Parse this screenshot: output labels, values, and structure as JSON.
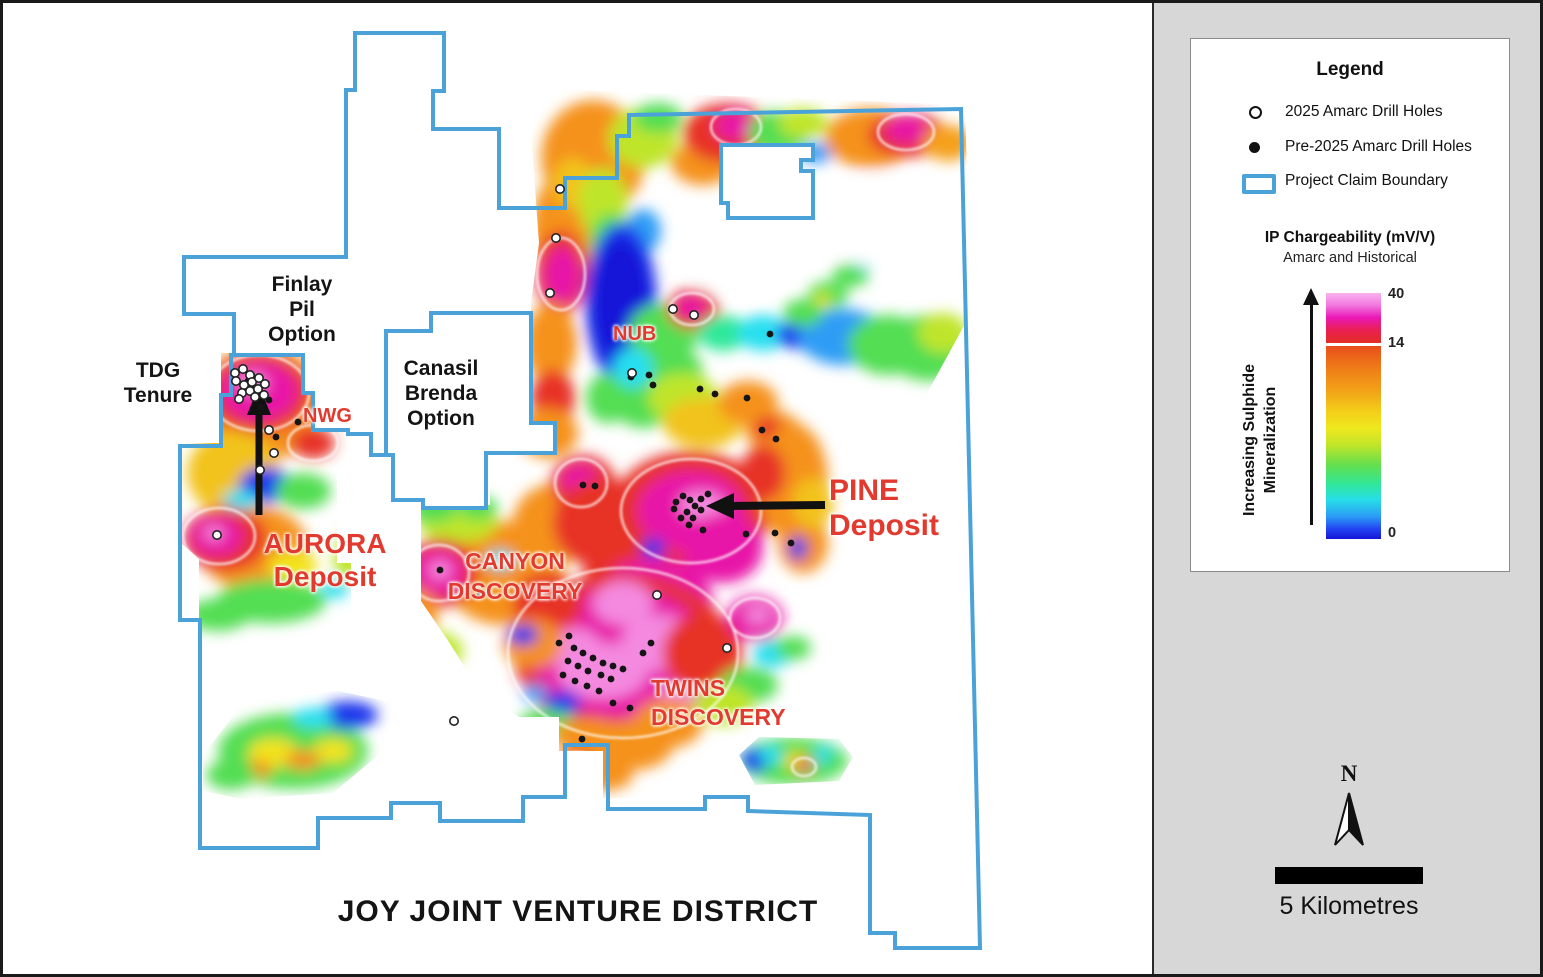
{
  "map": {
    "title": "JOY JOINT VENTURE DISTRICT",
    "areas": {
      "finlay": [
        "Finlay",
        "Pil",
        "Option"
      ],
      "tdg": [
        "TDG",
        "Tenure"
      ],
      "canasil": [
        "Canasil",
        "Brenda",
        "Option"
      ]
    },
    "zones": {
      "nwg": "NWG",
      "nub": "NUB",
      "canyon": [
        "CANYON",
        "DISCOVERY"
      ],
      "twins": [
        "TWINS",
        "DISCOVERY"
      ]
    },
    "deposits": {
      "aurora": [
        "AURORA",
        "Deposit"
      ],
      "pine": [
        "PINE",
        "Deposit"
      ]
    }
  },
  "legend": {
    "title": "Legend",
    "items": [
      {
        "symbol": "open-circle",
        "label": "2025 Amarc Drill Holes"
      },
      {
        "symbol": "filled-circle",
        "label": "Pre-2025 Amarc Drill Holes"
      },
      {
        "symbol": "boundary-box",
        "label": "Project Claim Boundary"
      }
    ],
    "ip": {
      "title": "IP Chargeability (mV/V)",
      "subtitle": "Amarc and Historical",
      "axis_label_line1": "Increasing Sulphide",
      "axis_label_line2": "Mineralization",
      "ticks": [
        "40",
        "14",
        "0"
      ]
    }
  },
  "scale": {
    "north": "N",
    "bar_label": "5 Kilometres"
  },
  "colors": {
    "boundary_blue": "#4BA2D9",
    "label_red": "#E23A2E",
    "panel_gray": "#D7D7D7",
    "scale_max_pink": "#F9B5EE",
    "scale_14_red": "#E52C28",
    "scale_min_blue": "#1616D6"
  }
}
